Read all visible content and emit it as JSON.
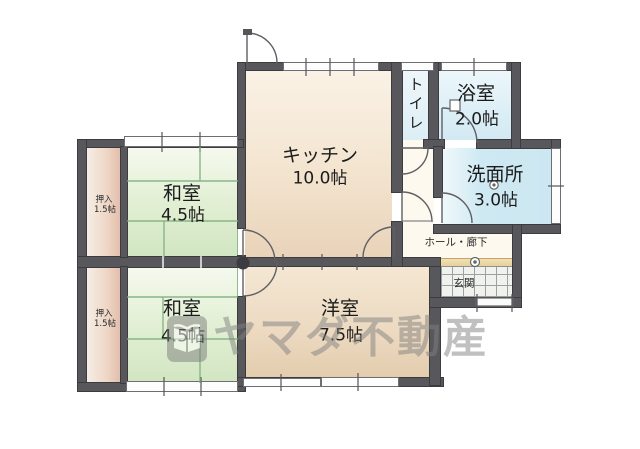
{
  "rooms": {
    "kitchen": {
      "name": "キッチン",
      "size": "10.0帖"
    },
    "toilet": {
      "name": "トイレ"
    },
    "bath": {
      "name": "浴室",
      "size": "2.0帖"
    },
    "washroom": {
      "name": "洗面所",
      "size": "3.0帖"
    },
    "hall": {
      "name": "ホール・廊下"
    },
    "entrance": {
      "name": "玄関"
    },
    "japanese_room_upper": {
      "name": "和室",
      "size": "4.5帖"
    },
    "japanese_room_lower": {
      "name": "和室",
      "size": "4.5帖"
    },
    "western_room": {
      "name": "洋室",
      "size": "7.5帖"
    },
    "closet_upper": {
      "name": "押入",
      "size": "1.5帖"
    },
    "closet_lower": {
      "name": "押入",
      "size": "1.5帖"
    }
  },
  "watermark": {
    "company": "ヤマダ不動産"
  },
  "colors": {
    "wall_gray": "#57575c",
    "tatami_green": "#d9eacc",
    "wood_beige": "#f3e6d2",
    "water_blue": "#d7edf6",
    "closet_pink": "#e9c9b8",
    "entrance_step": "#e9d6a2",
    "watermark_gray": "#828282"
  }
}
